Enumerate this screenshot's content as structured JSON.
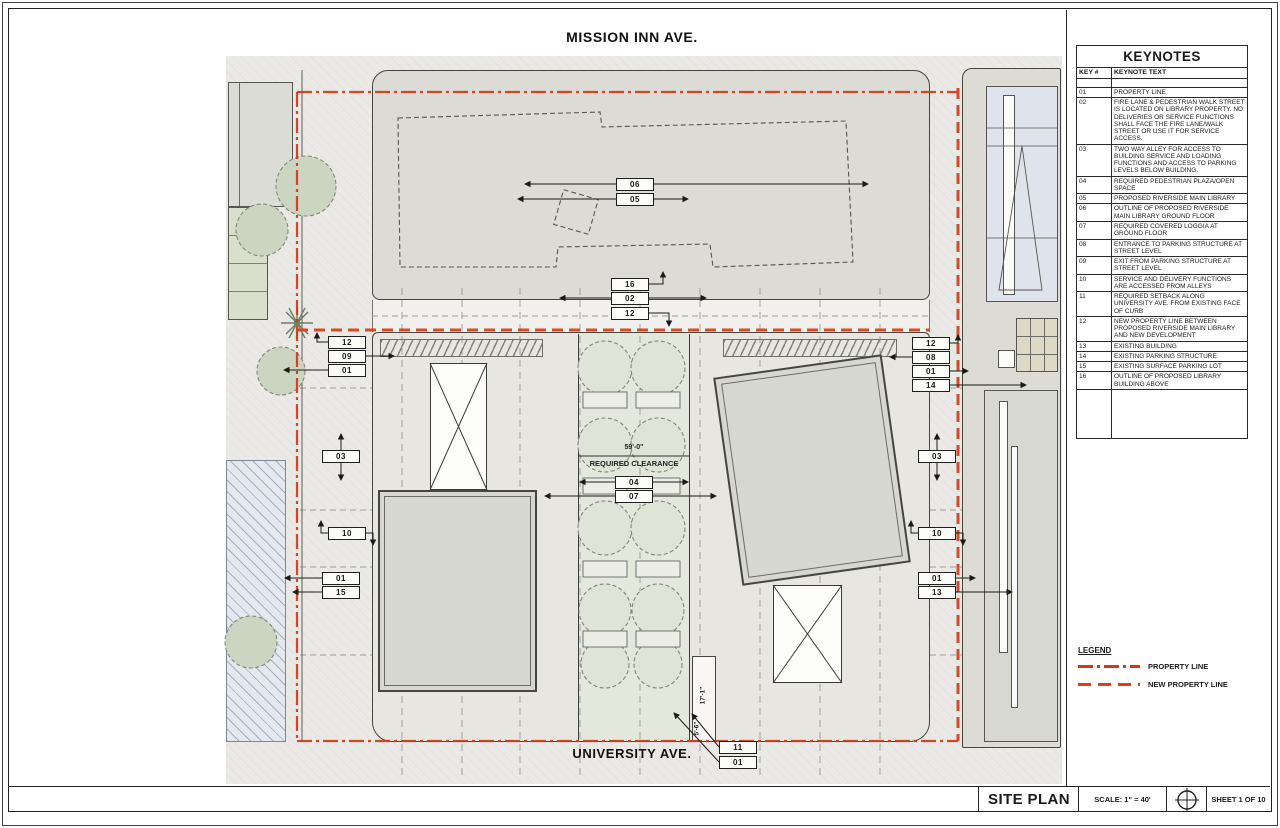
{
  "page": {
    "streets": {
      "top": "MISSION INN AVE.",
      "bottom": "UNIVERSITY AVE."
    }
  },
  "title_block": {
    "title": "SITE PLAN",
    "scale": "SCALE: 1\" = 40'",
    "sheet": "SHEET 1 OF 10",
    "north_icon": "north-arrow-icon"
  },
  "keynotes": {
    "title": "KEYNOTES",
    "columns": [
      "KEY #",
      "KEYNOTE TEXT"
    ],
    "rows": [
      {
        "key": "01",
        "text": "PROPERTY LINE"
      },
      {
        "key": "02",
        "text": "FIRE LANE & PEDESTRIAN WALK STREET IS LOCATED ON LIBRARY PROPERTY.  NO DELIVERIES OR SERVICE FUNCTIONS SHALL FACE THE FIRE LANE/WALK STREET OR USE IT FOR SERVICE ACCESS."
      },
      {
        "key": "03",
        "text": "TWO WAY ALLEY FOR ACCESS TO BUILDING SERVICE AND LOADING FUNCTIONS AND ACCESS TO PARKING LEVELS BELOW BUILDING."
      },
      {
        "key": "04",
        "text": "REQUIRED PEDESTRIAN PLAZA/OPEN SPACE"
      },
      {
        "key": "05",
        "text": "PROPOSED RIVERSIDE MAIN LIBRARY"
      },
      {
        "key": "06",
        "text": "OUTLINE OF PROPOSED RIVERSIDE MAIN LIBRARY GROUND FLOOR"
      },
      {
        "key": "07",
        "text": "REQUIRED COVERED LOGGIA AT GROUND FLOOR"
      },
      {
        "key": "08",
        "text": "ENTRANCE TO PARKING STRUCTURE AT STREET LEVEL"
      },
      {
        "key": "09",
        "text": "EXIT FROM PARKING STRUCTURE AT STREET LEVEL"
      },
      {
        "key": "10",
        "text": "SERVICE AND DELIVERY FUNCTIONS ARE ACCESSED FROM ALLEYS"
      },
      {
        "key": "11",
        "text": "REQUIRED SETBACK ALONG UNIVERSITY AVE. FROM EXISTING FACE OF CURB"
      },
      {
        "key": "12",
        "text": "NEW PROPERTY LINE BETWEEN PROPOSED RIVERSIDE MAIN LIBRARY AND NEW DEVELOPMENT"
      },
      {
        "key": "13",
        "text": "EXISTING BUILDING"
      },
      {
        "key": "14",
        "text": "EXISTING PARKING STRUCTURE"
      },
      {
        "key": "15",
        "text": "EXISTING SURFACE PARKING LOT"
      },
      {
        "key": "16",
        "text": "OUTLINE OF PROPOSED LIBRARY BUILDING ABOVE"
      }
    ]
  },
  "legend": {
    "title": "LEGEND",
    "items": [
      {
        "label": "PROPERTY LINE",
        "style": "dashdot"
      },
      {
        "label": "NEW PROPERTY LINE",
        "style": "dashed"
      }
    ]
  },
  "dims": {
    "clearance_width": "59'-0\"",
    "clearance_label": "REQUIRED CLEARANCE",
    "setback_a": "17'-1\"",
    "setback_b": "5'-6\""
  },
  "tags": [
    {
      "label": "06",
      "x": 635,
      "y": 184
    },
    {
      "label": "05",
      "x": 635,
      "y": 199
    },
    {
      "label": "16",
      "x": 630,
      "y": 284
    },
    {
      "label": "02",
      "x": 630,
      "y": 298
    },
    {
      "label": "12",
      "x": 630,
      "y": 313
    },
    {
      "label": "12",
      "x": 347,
      "y": 342
    },
    {
      "label": "09",
      "x": 347,
      "y": 356
    },
    {
      "label": "01",
      "x": 347,
      "y": 370
    },
    {
      "label": "12",
      "x": 931,
      "y": 343
    },
    {
      "label": "08",
      "x": 931,
      "y": 357
    },
    {
      "label": "01",
      "x": 931,
      "y": 371
    },
    {
      "label": "14",
      "x": 931,
      "y": 385
    },
    {
      "label": "03",
      "x": 341,
      "y": 456
    },
    {
      "label": "03",
      "x": 937,
      "y": 456
    },
    {
      "label": "10",
      "x": 347,
      "y": 533
    },
    {
      "label": "10",
      "x": 937,
      "y": 533
    },
    {
      "label": "04",
      "x": 634,
      "y": 482
    },
    {
      "label": "07",
      "x": 634,
      "y": 496
    },
    {
      "label": "01",
      "x": 341,
      "y": 578
    },
    {
      "label": "15",
      "x": 341,
      "y": 592
    },
    {
      "label": "01",
      "x": 937,
      "y": 578
    },
    {
      "label": "13",
      "x": 937,
      "y": 592
    },
    {
      "label": "11",
      "x": 738,
      "y": 747
    },
    {
      "label": "01",
      "x": 738,
      "y": 762
    }
  ],
  "colors": {
    "property_line": "#cf3a17",
    "new_property_line": "#d8401c",
    "street": "#eae9e6",
    "building": "#d7d7d1"
  }
}
